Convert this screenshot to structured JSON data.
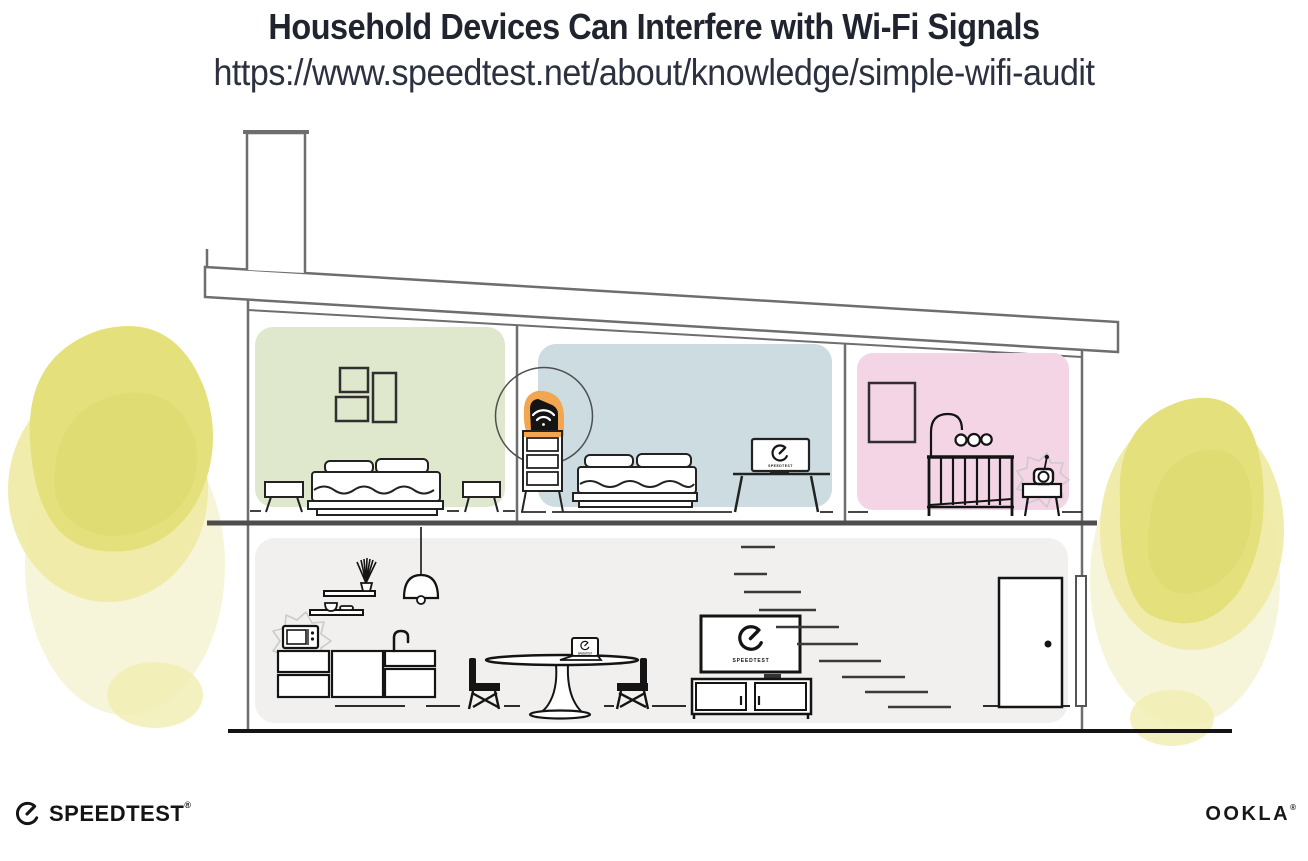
{
  "header": {
    "title": "Household Devices Can Interfere with Wi-Fi Signals",
    "url": "https://www.speedtest.net/about/knowledge/simple-wifi-audit"
  },
  "screens": {
    "speedtest_label": "SPEEDTEST"
  },
  "footer": {
    "speedtest_label": "SPEEDTEST",
    "speedtest_trademark": "®",
    "ookla_label": "OOKLA",
    "ookla_trademark": "®"
  },
  "icons": {
    "speedtest_gauge_icon": "circular-speedometer-with-needle",
    "wifi_icon": "wifi-arcs-on-router",
    "interference_burst_icon": "scribble-starburst"
  },
  "colors": {
    "bedroom_green": "#dfe8cc",
    "bedroom_blue": "#ccdce0",
    "nursery_pink": "#f4d5e5",
    "downstairs_gray": "#f1f0ee",
    "router_highlight_orange": "#f1a64f",
    "foliage_yellow": "#e4e07c",
    "structure_gray": "#6e6e6e",
    "ink": "#161616"
  }
}
